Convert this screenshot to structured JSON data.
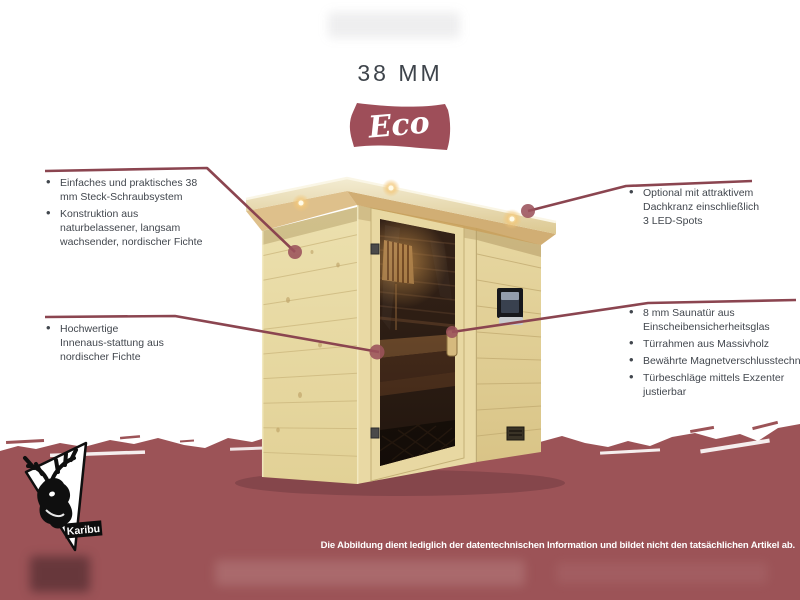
{
  "title": "38 MM",
  "series_badge": {
    "label": "Eco"
  },
  "annotations": {
    "left": [
      {
        "items": [
          "Einfaches und praktisches 38 mm Steck-Schraubsystem",
          "Konstruktion aus naturbelassener, langsam wachsender, nordischer Fichte"
        ]
      },
      {
        "items": [
          "Hochwertige Innenaus-stattung aus nordischer Fichte"
        ]
      }
    ],
    "right": [
      {
        "items": [
          "Optional mit attraktivem Dachkranz einschließlich 3 LED-Spots"
        ]
      },
      {
        "items": [
          "8 mm Saunatür aus Einscheibensicherheitsglas",
          "Türrahmen aus Massivholz",
          "Bewährte Magnetverschlusstechnik",
          "Türbeschläge mittels Exzenter justierbar"
        ]
      }
    ]
  },
  "footer": {
    "disclaimer": "Die Abbildung dient lediglich der datentechnischen Information und bildet nicht den tatsächlichen Artikel ab."
  },
  "logo": {
    "brand": "Karibu"
  },
  "product": {
    "subject": "corner sauna with glass door",
    "led_spots_shown": 3
  },
  "colors": {
    "band": "#9C5357",
    "badge": "#9E4E59",
    "annotation_line": "#8B4550",
    "annotation_dot": "#9B525B",
    "title_text": "#3E444B",
    "body_text": "#42474E",
    "wood_light": "#EADCA8",
    "glass_dark": "#2A1B12"
  }
}
